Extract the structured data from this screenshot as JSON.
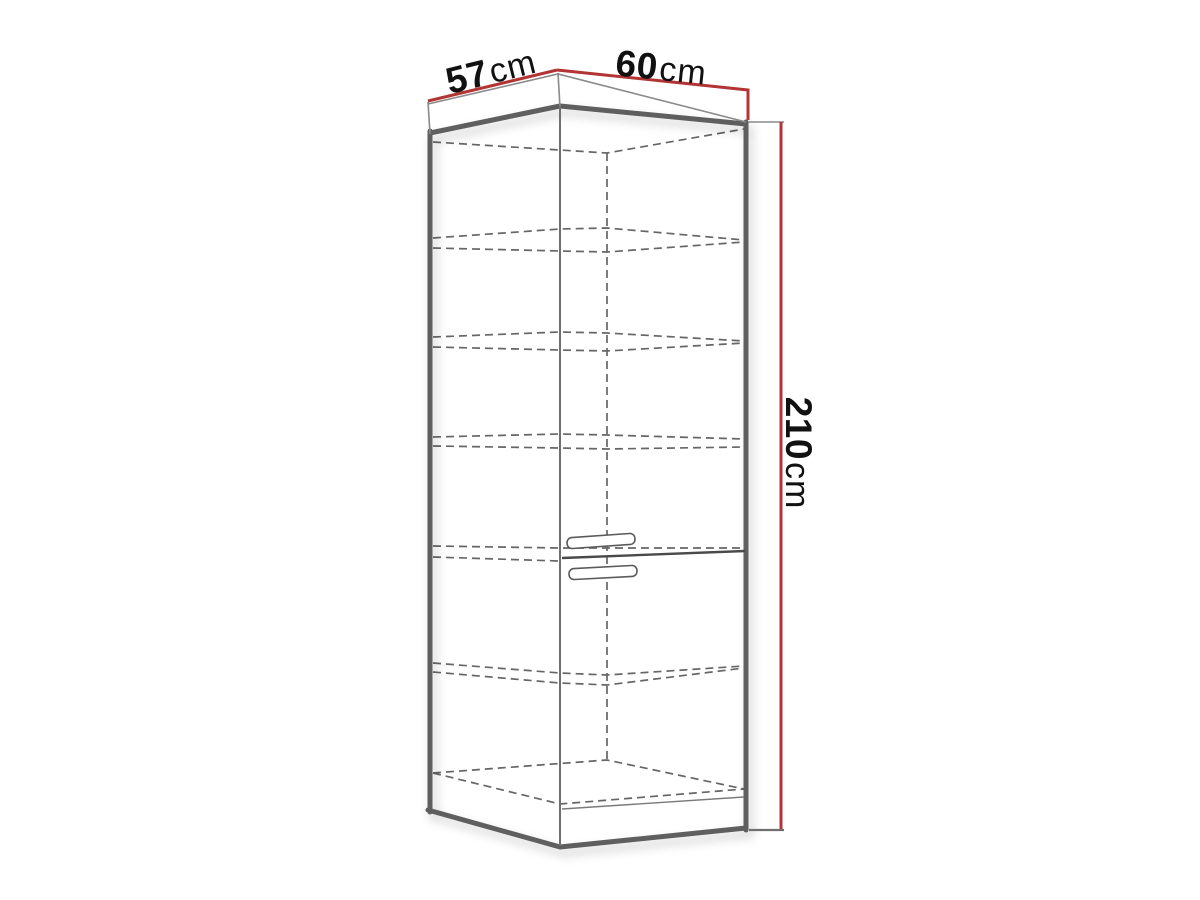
{
  "diagram": {
    "type": "furniture-dimension-drawing",
    "subject": "tall cabinet with internal shelves and two doors",
    "shelf_levels_visible": 5,
    "dimensions": {
      "top_left": {
        "value": "57",
        "unit": "cm"
      },
      "top_right": {
        "value": "60",
        "unit": "cm"
      },
      "height": {
        "value": "210",
        "unit": "cm"
      }
    },
    "colors": {
      "dimension_line": "#b23434",
      "outline": "#5f5f5f",
      "thin_line": "#8a8a8a",
      "dashed_line": "#666666",
      "text": "#111111",
      "background": "#ffffff"
    }
  }
}
